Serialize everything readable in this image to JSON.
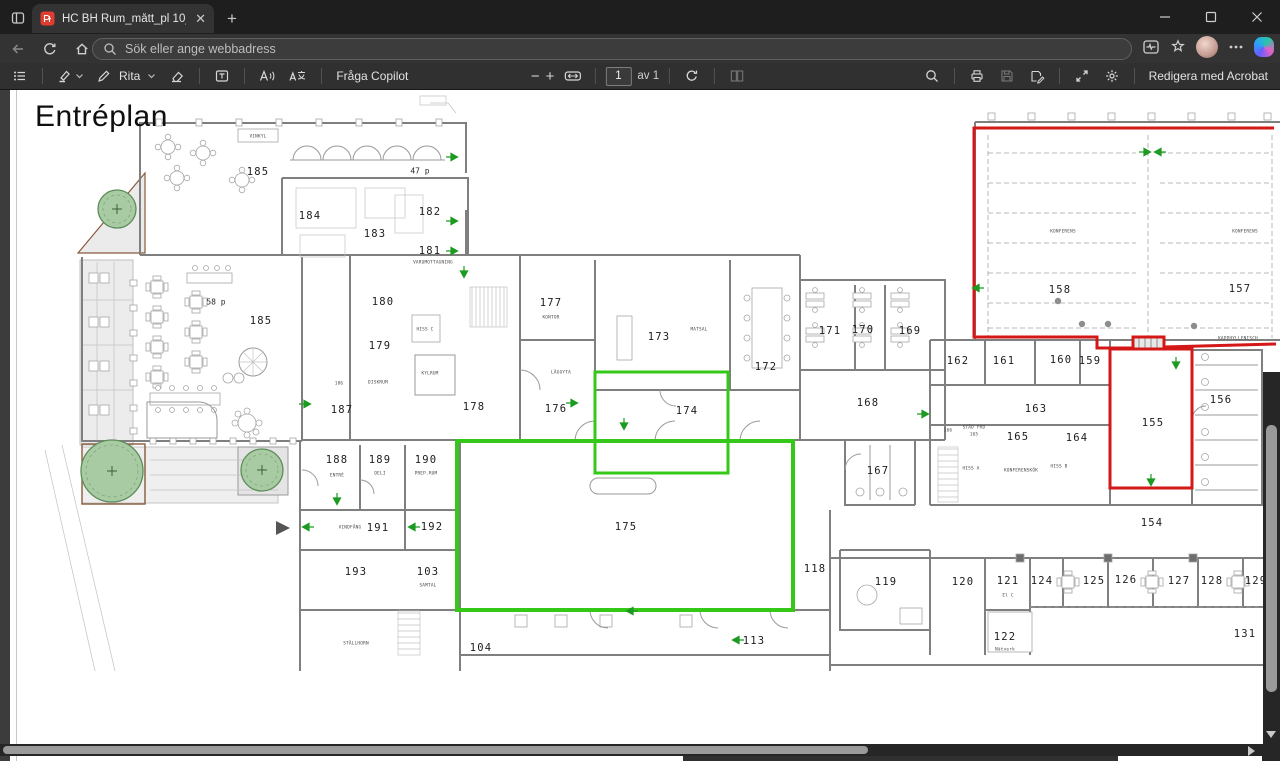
{
  "browser": {
    "tab": {
      "title": "HC BH Rum_mått_pl 10_11_liten.p",
      "close": "✕"
    },
    "new_tab": "+",
    "address": {
      "placeholder": "Sök eller ange webbadress"
    }
  },
  "pdf_toolbar": {
    "draw_label": "Rita",
    "ask_copilot_label": "Fråga Copilot",
    "page_value": "1",
    "page_of_label": "av 1",
    "acrobat_label": "Redigera med Acrobat",
    "zoom_out": "−",
    "zoom_in": "+"
  },
  "doc": {
    "title": "Entréplan"
  },
  "plan": {
    "colors": {
      "highlight_green": "#35c818",
      "highlight_red": "#d41717",
      "arrow_green": "#1c9a22",
      "tree_fill": "#a9cba4"
    },
    "green_rects": [
      {
        "x": 595,
        "y": 372,
        "w": 133,
        "h": 101,
        "sw": 3
      },
      {
        "x": 457,
        "y": 441,
        "w": 336,
        "h": 169,
        "sw": 4
      }
    ],
    "red_path": "M1274,128 L974,128 L974,337 L1097,337 L1097,348 L1133,348 L1133,337 L1164,337 L1164,347 L1276,344",
    "red_room": {
      "x": 1110,
      "y": 349,
      "w": 82,
      "h": 139
    },
    "trees": [
      {
        "x": 112,
        "y": 471,
        "r": 31
      },
      {
        "x": 262,
        "y": 470,
        "r": 21
      },
      {
        "x": 117,
        "y": 209,
        "r": 19
      }
    ],
    "conference_dots": [
      {
        "x": 1058,
        "y": 301
      },
      {
        "x": 1082,
        "y": 324
      },
      {
        "x": 1108,
        "y": 324
      },
      {
        "x": 1194,
        "y": 326
      }
    ],
    "arrows": [
      {
        "x": 452,
        "y": 157,
        "d": "r"
      },
      {
        "x": 452,
        "y": 221,
        "d": "r"
      },
      {
        "x": 452,
        "y": 251,
        "d": "r"
      },
      {
        "x": 464,
        "y": 272,
        "d": "d"
      },
      {
        "x": 305,
        "y": 404,
        "d": "r"
      },
      {
        "x": 572,
        "y": 403,
        "d": "r"
      },
      {
        "x": 624,
        "y": 424,
        "d": "d"
      },
      {
        "x": 923,
        "y": 414,
        "d": "r"
      },
      {
        "x": 978,
        "y": 288,
        "d": "l"
      },
      {
        "x": 1145,
        "y": 152,
        "d": "r"
      },
      {
        "x": 1160,
        "y": 152,
        "d": "l"
      },
      {
        "x": 1176,
        "y": 363,
        "d": "d"
      },
      {
        "x": 1151,
        "y": 480,
        "d": "d"
      },
      {
        "x": 337,
        "y": 499,
        "d": "d"
      },
      {
        "x": 308,
        "y": 527,
        "d": "l"
      },
      {
        "x": 414,
        "y": 527,
        "d": "l"
      },
      {
        "x": 632,
        "y": 611,
        "d": "l"
      },
      {
        "x": 738,
        "y": 640,
        "d": "l"
      }
    ],
    "labels": [
      {
        "t": "185",
        "x": 258,
        "y": 172,
        "s": "lg"
      },
      {
        "t": "47 p",
        "x": 420,
        "y": 171,
        "s": "md"
      },
      {
        "t": "VINKYL",
        "x": 258,
        "y": 136,
        "s": "xs"
      },
      {
        "t": "184",
        "x": 310,
        "y": 216,
        "s": "lg"
      },
      {
        "t": "183",
        "x": 375,
        "y": 234,
        "s": "lg"
      },
      {
        "t": "182",
        "x": 430,
        "y": 212,
        "s": "lg"
      },
      {
        "t": "181",
        "x": 430,
        "y": 251,
        "s": "lg"
      },
      {
        "t": "VARUMOTTAGNING",
        "x": 433,
        "y": 262,
        "s": "xs"
      },
      {
        "t": "180",
        "x": 383,
        "y": 302,
        "s": "lg"
      },
      {
        "t": "HISS C",
        "x": 425,
        "y": 329,
        "s": "xs"
      },
      {
        "t": "179",
        "x": 380,
        "y": 346,
        "s": "lg"
      },
      {
        "t": "KYLRUM",
        "x": 430,
        "y": 373,
        "s": "xs"
      },
      {
        "t": "DISKRUM",
        "x": 378,
        "y": 382,
        "s": "xs"
      },
      {
        "t": "178",
        "x": 474,
        "y": 407,
        "s": "lg"
      },
      {
        "t": "177",
        "x": 551,
        "y": 303,
        "s": "lg"
      },
      {
        "t": "KONTOR",
        "x": 551,
        "y": 317,
        "s": "xs"
      },
      {
        "t": "LÄGGYTA",
        "x": 561,
        "y": 372,
        "s": "xs"
      },
      {
        "t": "176",
        "x": 556,
        "y": 409,
        "s": "lg"
      },
      {
        "t": "173",
        "x": 659,
        "y": 337,
        "s": "lg"
      },
      {
        "t": "MATSAL",
        "x": 699,
        "y": 329,
        "s": "xs"
      },
      {
        "t": "174",
        "x": 687,
        "y": 411,
        "s": "lg"
      },
      {
        "t": "172",
        "x": 766,
        "y": 367,
        "s": "lg"
      },
      {
        "t": "171",
        "x": 830,
        "y": 331,
        "s": "lg"
      },
      {
        "t": "170",
        "x": 863,
        "y": 330,
        "s": "lg"
      },
      {
        "t": "169",
        "x": 910,
        "y": 331,
        "s": "lg"
      },
      {
        "t": "168",
        "x": 868,
        "y": 403,
        "s": "lg"
      },
      {
        "t": "167",
        "x": 878,
        "y": 471,
        "s": "lg"
      },
      {
        "t": "166",
        "x": 948,
        "y": 430,
        "s": "xs"
      },
      {
        "t": "STÄD FRD",
        "x": 974,
        "y": 427,
        "s": "xs"
      },
      {
        "t": "165",
        "x": 974,
        "y": 434,
        "s": "xs"
      },
      {
        "t": "165",
        "x": 1018,
        "y": 437,
        "s": "lg"
      },
      {
        "t": "HISS A",
        "x": 971,
        "y": 468,
        "s": "xs"
      },
      {
        "t": "KONFERENSKÖK",
        "x": 1021,
        "y": 470,
        "s": "xs"
      },
      {
        "t": "HISS B",
        "x": 1059,
        "y": 466,
        "s": "xs"
      },
      {
        "t": "164",
        "x": 1077,
        "y": 438,
        "s": "lg"
      },
      {
        "t": "163",
        "x": 1036,
        "y": 409,
        "s": "lg"
      },
      {
        "t": "162",
        "x": 958,
        "y": 361,
        "s": "lg"
      },
      {
        "t": "161",
        "x": 1004,
        "y": 361,
        "s": "lg"
      },
      {
        "t": "160",
        "x": 1061,
        "y": 360,
        "s": "lg"
      },
      {
        "t": "159",
        "x": 1090,
        "y": 361,
        "s": "lg"
      },
      {
        "t": "158",
        "x": 1060,
        "y": 290,
        "s": "lg"
      },
      {
        "t": "157",
        "x": 1240,
        "y": 289,
        "s": "lg"
      },
      {
        "t": "KONFERENS",
        "x": 1063,
        "y": 231,
        "s": "xs"
      },
      {
        "t": "KONFERENS",
        "x": 1245,
        "y": 231,
        "s": "xs"
      },
      {
        "t": "KAPPHYLLENISCH",
        "x": 1238,
        "y": 338,
        "s": "xs"
      },
      {
        "t": "156",
        "x": 1221,
        "y": 400,
        "s": "lg"
      },
      {
        "t": "155",
        "x": 1153,
        "y": 423,
        "s": "lg"
      },
      {
        "t": "154",
        "x": 1152,
        "y": 523,
        "s": "lg"
      },
      {
        "t": "185",
        "x": 261,
        "y": 321,
        "s": "lg"
      },
      {
        "t": "58 p",
        "x": 216,
        "y": 302,
        "s": "md"
      },
      {
        "t": "186",
        "x": 339,
        "y": 383,
        "s": "xs"
      },
      {
        "t": "187",
        "x": 342,
        "y": 410,
        "s": "lg"
      },
      {
        "t": "188",
        "x": 337,
        "y": 460,
        "s": "lg"
      },
      {
        "t": "ENTRÉ",
        "x": 337,
        "y": 475,
        "s": "xs"
      },
      {
        "t": "189",
        "x": 380,
        "y": 460,
        "s": "lg"
      },
      {
        "t": "DELI",
        "x": 380,
        "y": 473,
        "s": "xs"
      },
      {
        "t": "190",
        "x": 426,
        "y": 460,
        "s": "lg"
      },
      {
        "t": "PREP.RUM",
        "x": 426,
        "y": 473,
        "s": "xs"
      },
      {
        "t": "VINDFÅNG",
        "x": 350,
        "y": 527,
        "s": "xs"
      },
      {
        "t": "191",
        "x": 378,
        "y": 528,
        "s": "lg"
      },
      {
        "t": "192",
        "x": 432,
        "y": 527,
        "s": "lg"
      },
      {
        "t": "193",
        "x": 356,
        "y": 572,
        "s": "lg"
      },
      {
        "t": "103",
        "x": 428,
        "y": 572,
        "s": "lg"
      },
      {
        "t": "SAMTAL",
        "x": 428,
        "y": 585,
        "s": "xs"
      },
      {
        "t": "104",
        "x": 481,
        "y": 648,
        "s": "lg"
      },
      {
        "t": "STÄLLHORN",
        "x": 356,
        "y": 643,
        "s": "xs"
      },
      {
        "t": "113",
        "x": 754,
        "y": 641,
        "s": "lg"
      },
      {
        "t": "175",
        "x": 626,
        "y": 527,
        "s": "lg"
      },
      {
        "t": "118",
        "x": 815,
        "y": 569,
        "s": "lg"
      },
      {
        "t": "119",
        "x": 886,
        "y": 582,
        "s": "lg"
      },
      {
        "t": "120",
        "x": 963,
        "y": 582,
        "s": "lg"
      },
      {
        "t": "121",
        "x": 1008,
        "y": 581,
        "s": "lg"
      },
      {
        "t": "El C",
        "x": 1008,
        "y": 595,
        "s": "xs"
      },
      {
        "t": "122",
        "x": 1005,
        "y": 637,
        "s": "lg"
      },
      {
        "t": "Nätverk",
        "x": 1005,
        "y": 649,
        "s": "xs"
      },
      {
        "t": "124",
        "x": 1042,
        "y": 581,
        "s": "lg"
      },
      {
        "t": "125",
        "x": 1094,
        "y": 581,
        "s": "lg"
      },
      {
        "t": "126",
        "x": 1126,
        "y": 580,
        "s": "lg"
      },
      {
        "t": "127",
        "x": 1179,
        "y": 581,
        "s": "lg"
      },
      {
        "t": "128",
        "x": 1212,
        "y": 581,
        "s": "lg"
      },
      {
        "t": "129",
        "x": 1256,
        "y": 581,
        "s": "lg"
      },
      {
        "t": "131",
        "x": 1245,
        "y": 634,
        "s": "lg"
      }
    ]
  }
}
